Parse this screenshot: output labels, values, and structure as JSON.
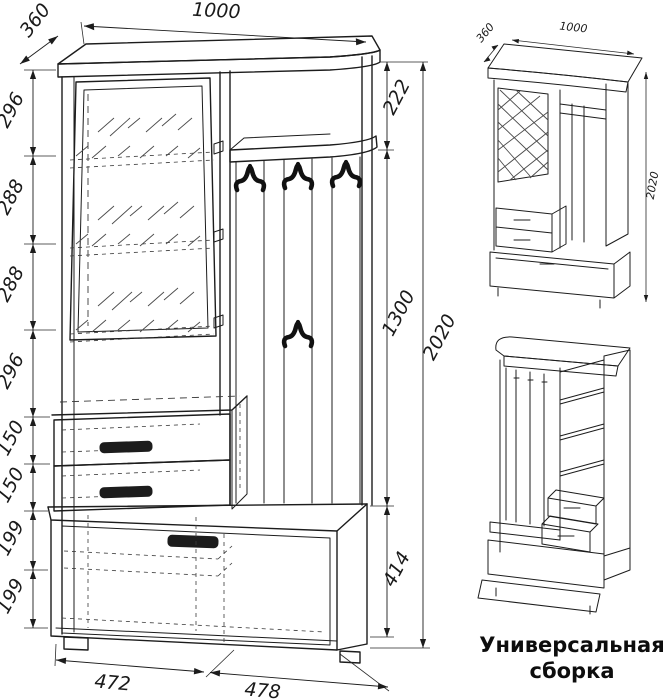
{
  "caption": {
    "line1": "Универсальная",
    "line2": "сборка"
  },
  "main_view": {
    "description": "front technical drawing of hallway unit",
    "dims": {
      "width_top": "1000",
      "depth": "360",
      "left_chain": [
        "296",
        "288",
        "288",
        "296",
        "150",
        "150",
        "199",
        "199"
      ],
      "right_upper": "222",
      "right_middle": "1300",
      "right_lower": "414",
      "height_total": "2020",
      "bottom_left": "472",
      "bottom_right": "478"
    }
  },
  "iso_view": {
    "dims": {
      "depth": "360",
      "width": "1000",
      "height": "2020"
    }
  }
}
